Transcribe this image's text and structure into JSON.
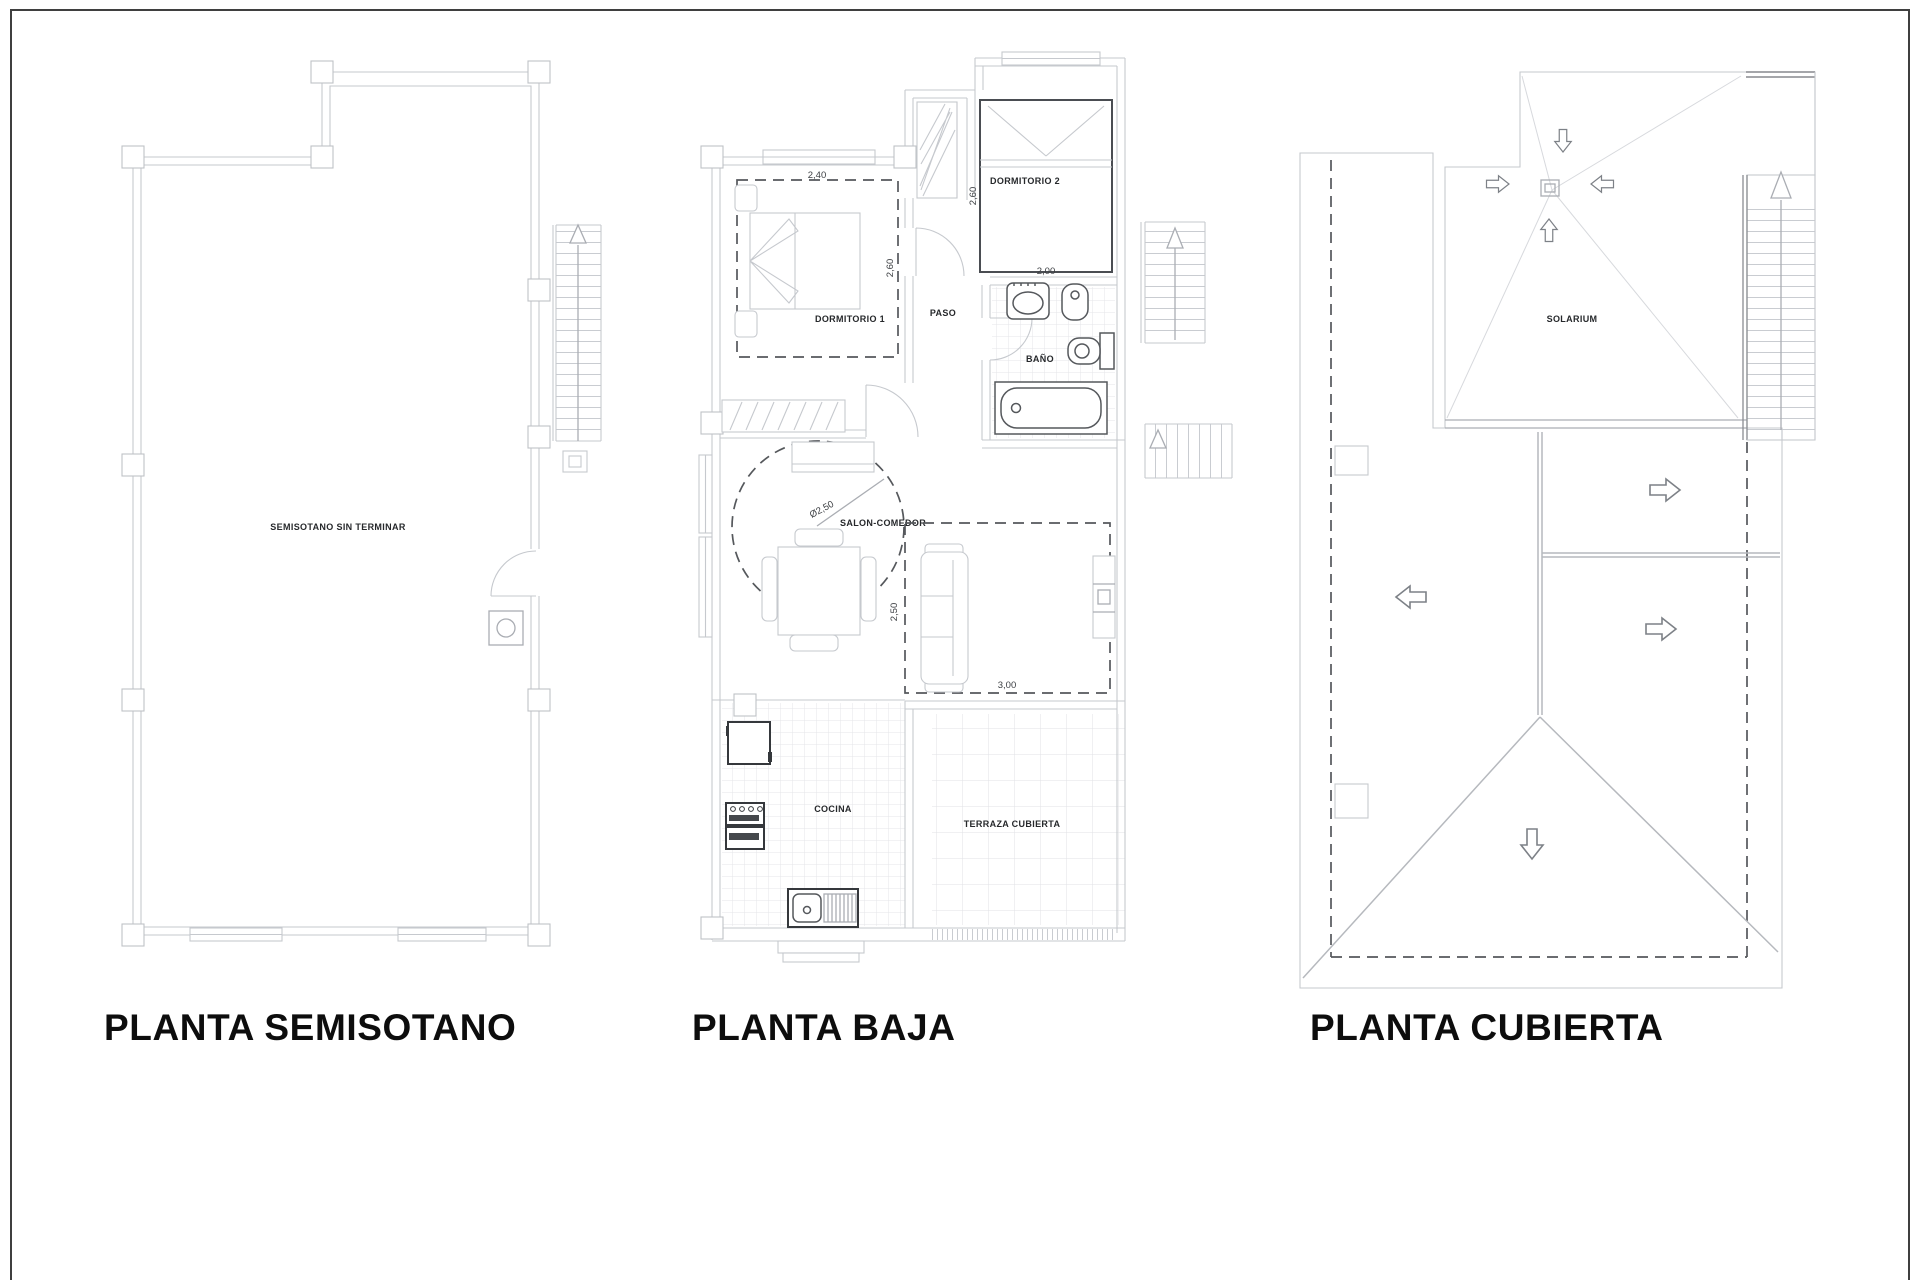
{
  "page": {
    "background": "#ffffff",
    "frame_color": "#3f3f3f",
    "line_light": "#c6c9ce",
    "line_dark": "#55585c",
    "text_color": "#26282b"
  },
  "titles": {
    "semisotano": "PLANTA SEMISOTANO",
    "baja": "PLANTA BAJA",
    "cubierta": "PLANTA CUBIERTA"
  },
  "semisotano": {
    "room_label": "SEMISOTANO SIN TERMINAR"
  },
  "baja": {
    "rooms": {
      "dormitorio1": "DORMITORIO 1",
      "dormitorio2": "DORMITORIO 2",
      "paso": "PASO",
      "bano": "BAÑO",
      "salon": "SALON-COMEDOR",
      "cocina": "COCINA",
      "terraza": "TERRAZA CUBIERTA"
    },
    "dims": {
      "dorm1_width": "2,40",
      "dorm1_depth": "2,60",
      "dorm2_depth": "2,60",
      "dorm2_width": "2,00",
      "salon_diameter": "Ø2,50",
      "estar_depth": "2,50",
      "estar_width": "3,00"
    }
  },
  "cubierta": {
    "solarium": "SOLARIUM"
  }
}
